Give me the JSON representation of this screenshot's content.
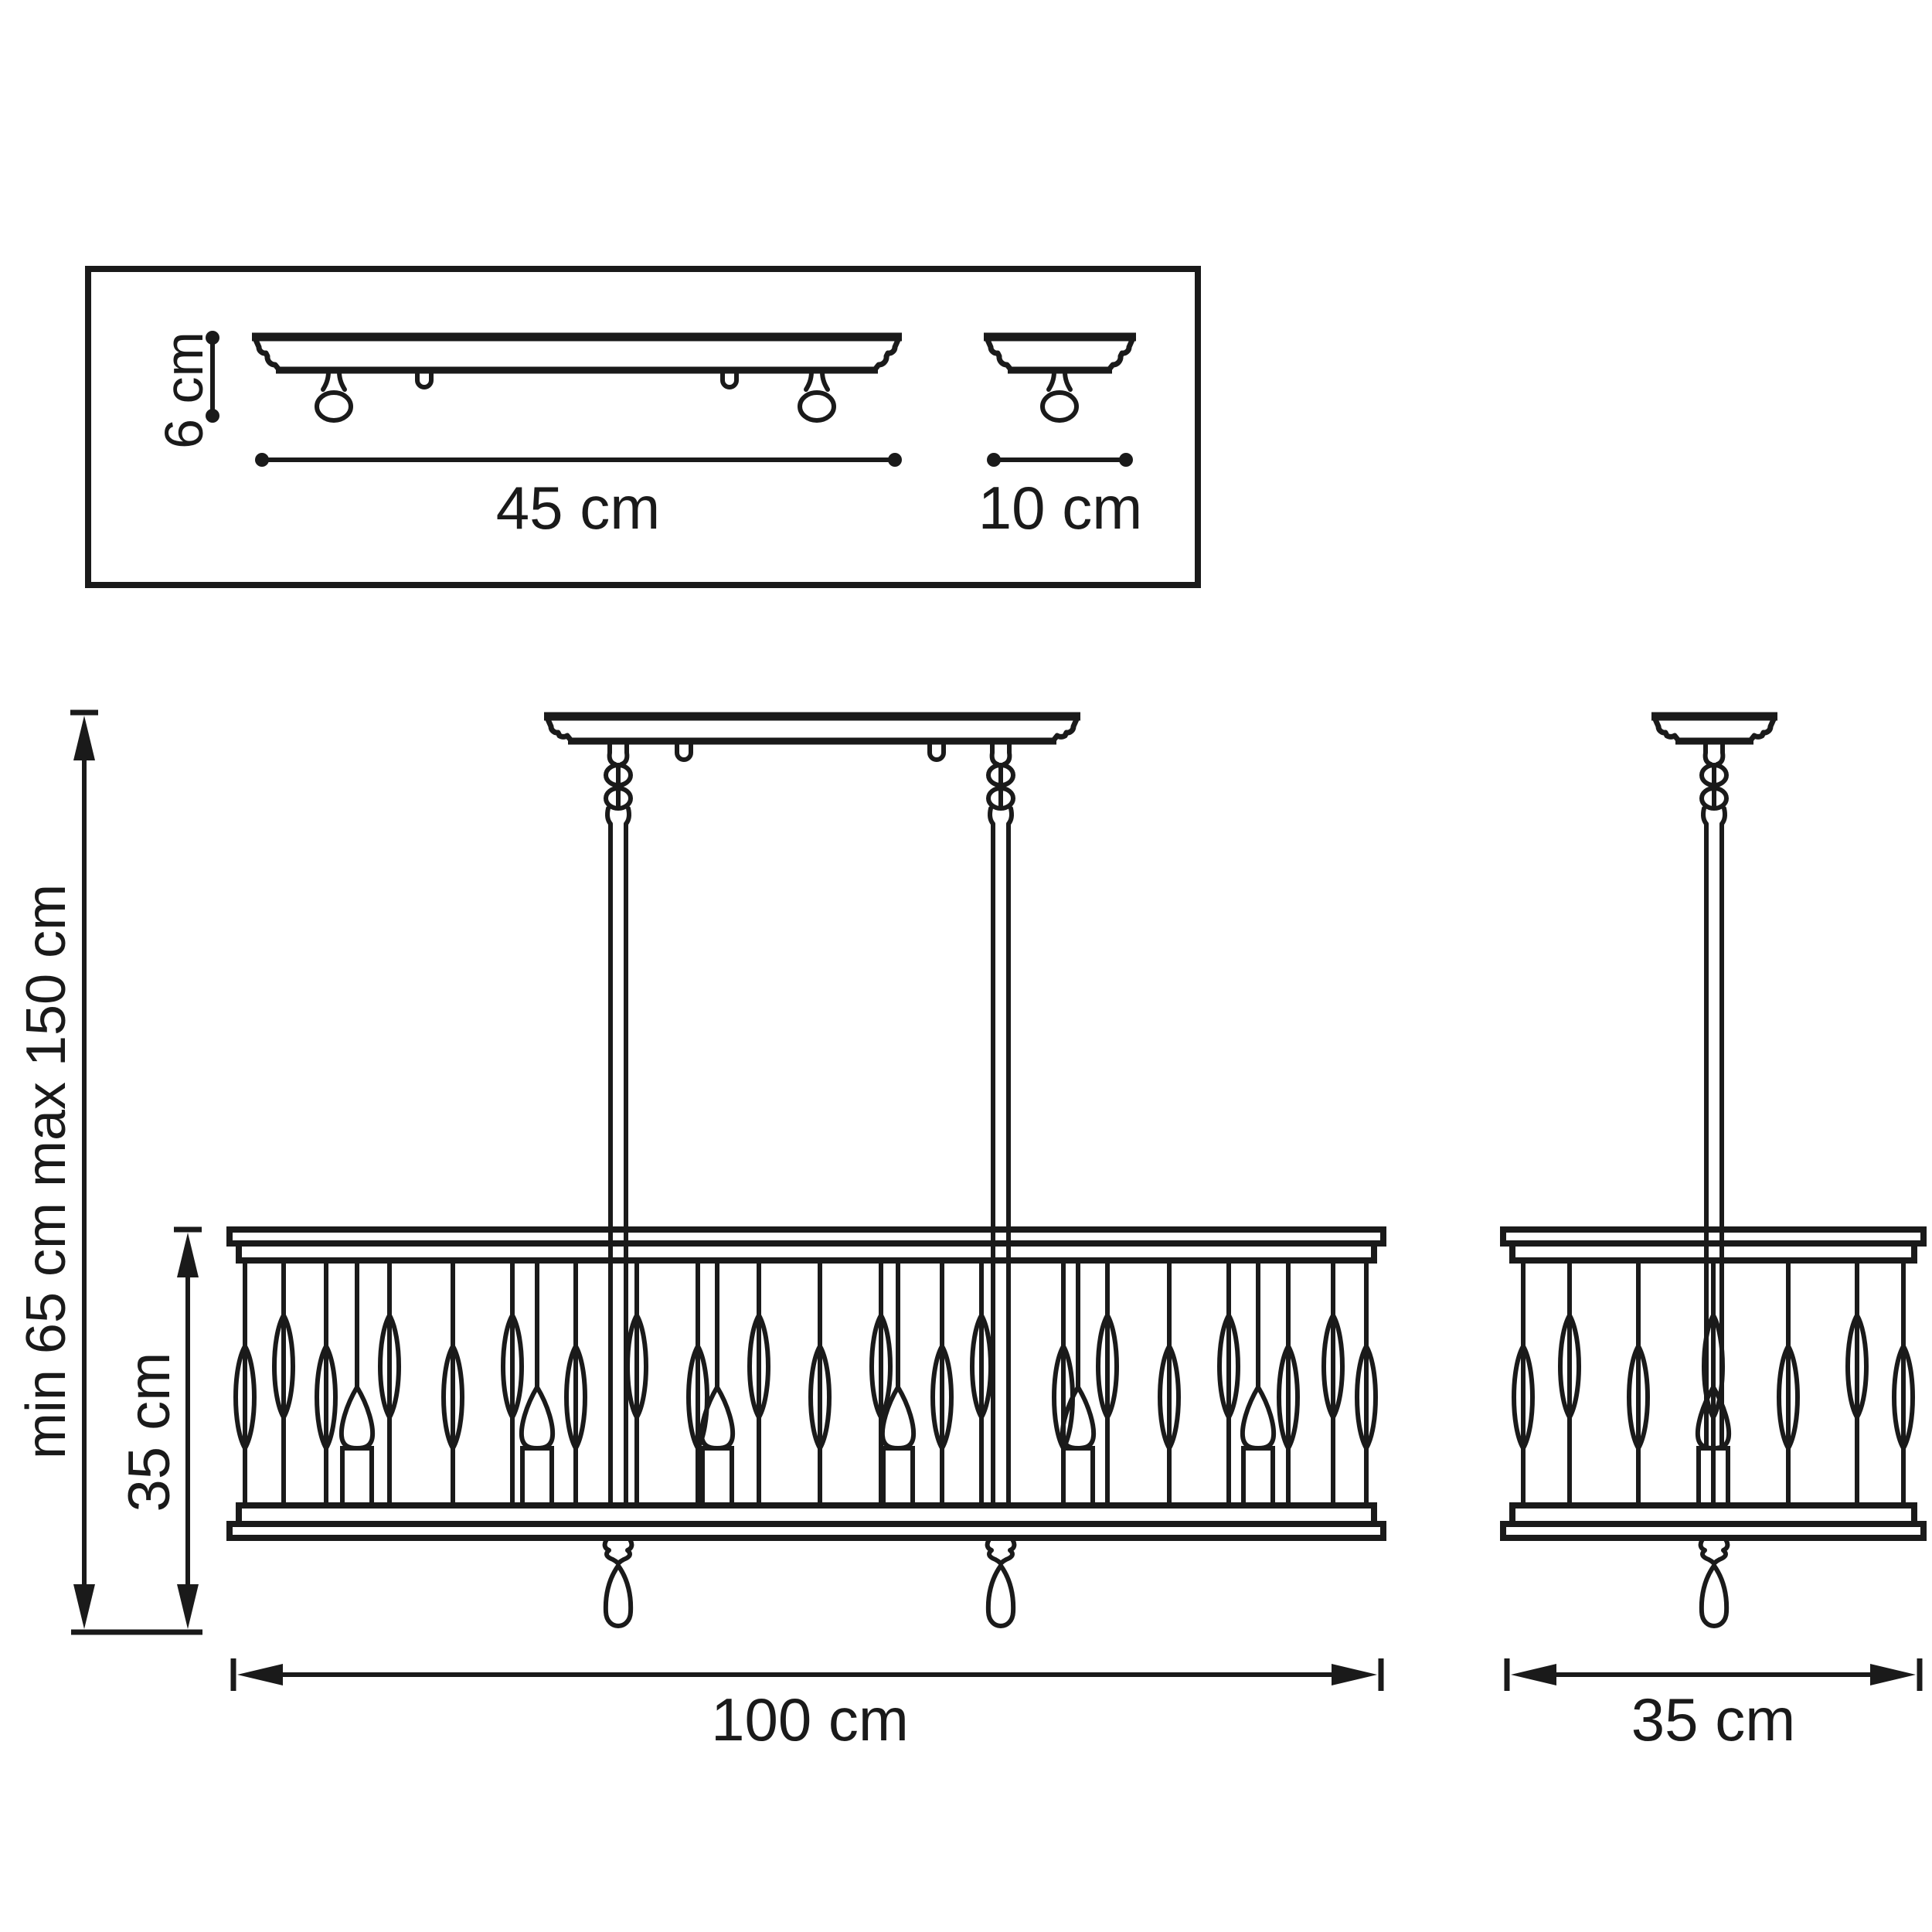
{
  "page": {
    "title": "Linear chandelier dimension drawing",
    "background": "#ffffff",
    "ink": "#1a1a1a"
  },
  "labels": {
    "plate_length": "45 cm",
    "plate_width": "10 cm",
    "plate_height": "6 cm",
    "suspension_height": "min 65 cm max 150 cm",
    "shade_height": "35 cm",
    "fixture_length": "100 cm",
    "fixture_depth": "35 cm"
  },
  "views": {
    "ceiling_plates_panel": {
      "description": "Top view panel: long mounting plate and round mounting plate profiles",
      "long_plate_lamp_balls": 2,
      "long_plate_hooks": 2,
      "short_plate_lamp_balls": 1
    },
    "front_view": {
      "suspension_rods": 2,
      "chain_links_per_rod": 2,
      "candles": 6,
      "decor_ovals": 21,
      "crystal_drops": 2,
      "canopy_hooks": 2
    },
    "side_view": {
      "suspension_rods": 1,
      "candles": 1,
      "decor_ovals": 7,
      "crystal_drops": 1
    }
  }
}
